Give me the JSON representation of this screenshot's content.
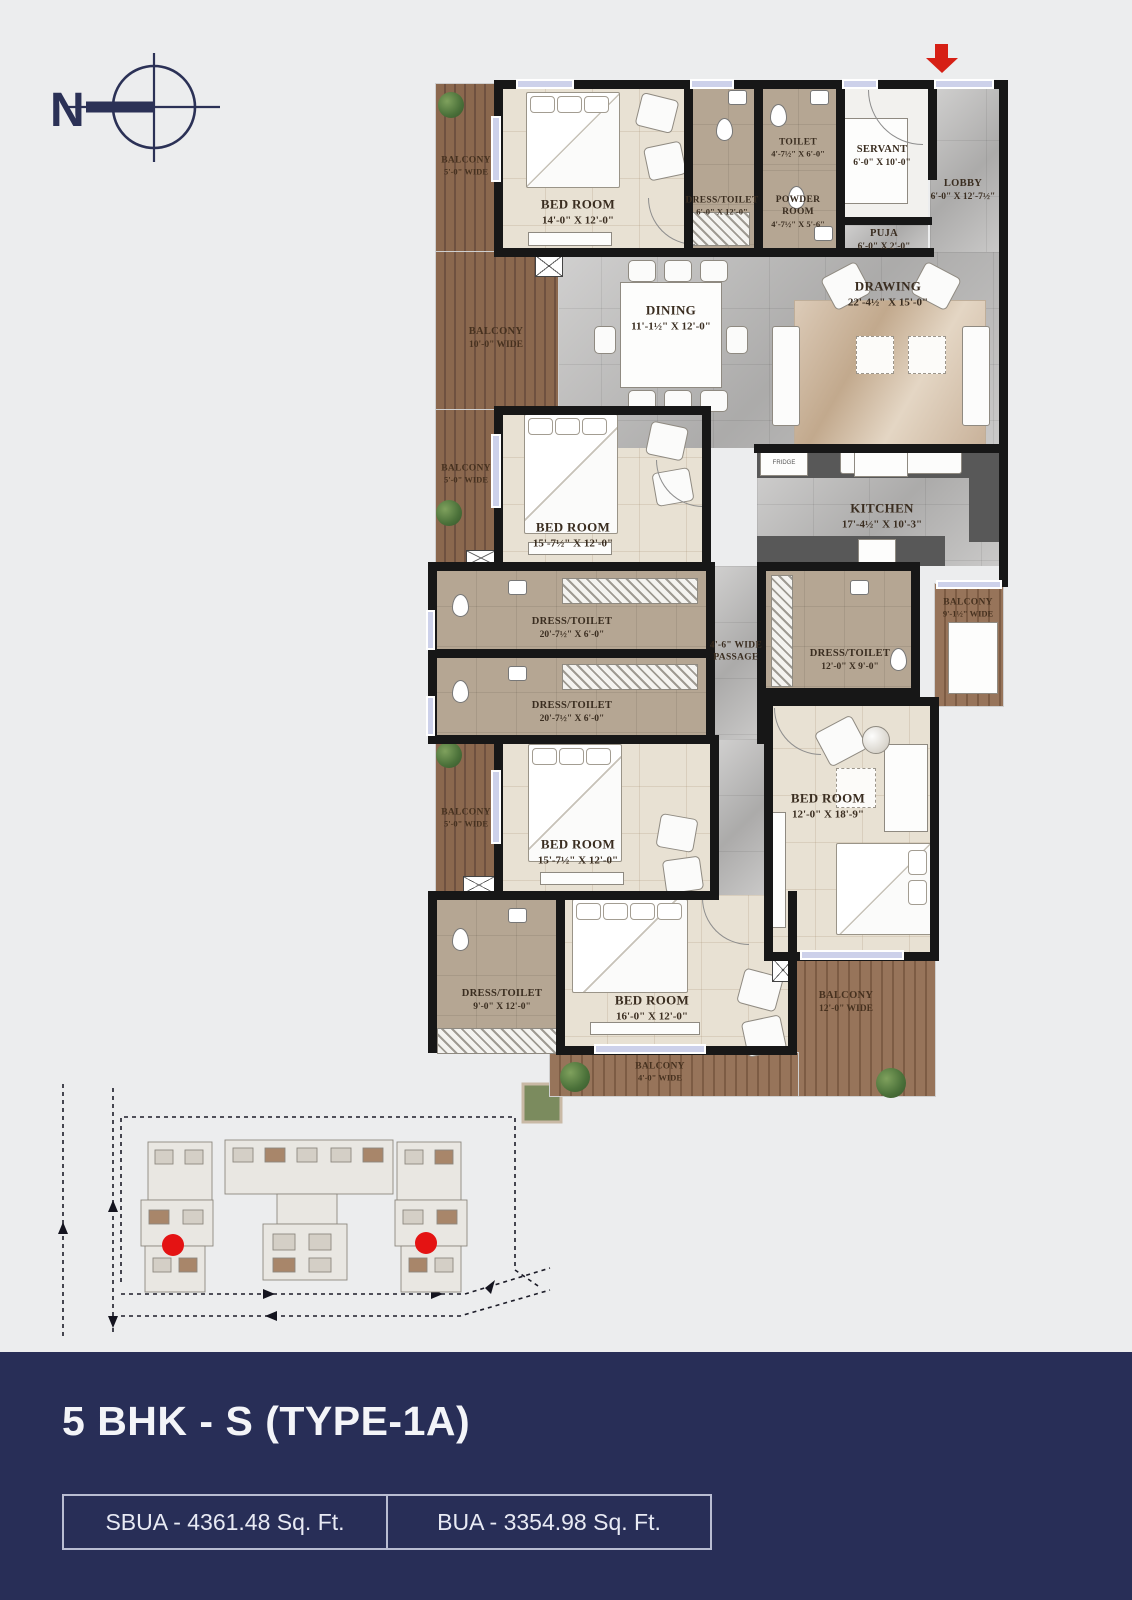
{
  "compass": {
    "label": "N"
  },
  "rooms": [
    {
      "id": "balcony-5-top",
      "line1": "BALCONY",
      "line2": "5'-0\" WIDE"
    },
    {
      "id": "bedroom-14x12",
      "line1": "BED ROOM",
      "line2": "14'-0\" X 12'-0\""
    },
    {
      "id": "dress-toilet-6x12",
      "line1": "DRESS/TOILET",
      "line2": "6'-0\" X 12'-0\""
    },
    {
      "id": "toilet",
      "line1": "TOILET",
      "line2": "4'-7½\" X 6'-0\""
    },
    {
      "id": "powder-room",
      "line1": "POWDER",
      "line2": "ROOM",
      "line3": "4'-7½\" X 5'-6\""
    },
    {
      "id": "servant",
      "line1": "SERVANT",
      "line2": "6'-0\" X 10'-0\""
    },
    {
      "id": "lobby",
      "line1": "LOBBY",
      "line2": "6'-0\" X 12'-7½\""
    },
    {
      "id": "puja",
      "line1": "PUJA",
      "line2": "6'-0\" X 2'-0\""
    },
    {
      "id": "balcony-10",
      "line1": "BALCONY",
      "line2": "10'-0\" WIDE"
    },
    {
      "id": "dining",
      "line1": "DINING",
      "line2": "11'-1½\" X 12'-0\""
    },
    {
      "id": "drawing",
      "line1": "DRAWING",
      "line2": "22'-4½\" X 15'-0\""
    },
    {
      "id": "balcony-5-mid",
      "line1": "BALCONY",
      "line2": "5'-0\" WIDE"
    },
    {
      "id": "bedroom-15a",
      "line1": "BED ROOM",
      "line2": "15'-7½\" X 12'-0\""
    },
    {
      "id": "kitchen",
      "line1": "KITCHEN",
      "line2": "17'-4½\" X 10'-3\""
    },
    {
      "id": "dress-toilet-20a",
      "line1": "DRESS/TOILET",
      "line2": "20'-7½\" X 6'-0\""
    },
    {
      "id": "dress-toilet-20b",
      "line1": "DRESS/TOILET",
      "line2": "20'-7½\" X 6'-0\""
    },
    {
      "id": "passage",
      "line1": "4'-6\" WIDE",
      "line2": "PASSAGE"
    },
    {
      "id": "dress-toilet-12x9",
      "line1": "DRESS/TOILET",
      "line2": "12'-0\" X 9'-0\""
    },
    {
      "id": "balcony-9",
      "line1": "BALCONY",
      "line2": "9'-1½\" WIDE"
    },
    {
      "id": "bedroom-12x18",
      "line1": "BED ROOM",
      "line2": "12'-0\" X 18'-9\""
    },
    {
      "id": "balcony-5-low",
      "line1": "BALCONY",
      "line2": "5'-0\" WIDE"
    },
    {
      "id": "bedroom-15b",
      "line1": "BED ROOM",
      "line2": "15'-7½\" X 12'-0\""
    },
    {
      "id": "dress-toilet-9x12",
      "line1": "DRESS/TOILET",
      "line2": "9'-0\" X 12'-0\""
    },
    {
      "id": "bedroom-16x12",
      "line1": "BED ROOM",
      "line2": "16'-0\" X 12'-0\""
    },
    {
      "id": "balcony-12",
      "line1": "BALCONY",
      "line2": "12'-0\" WIDE"
    },
    {
      "id": "balcony-4",
      "line1": "BALCONY",
      "line2": "4'-0\" WIDE"
    }
  ],
  "kitchen": {
    "fridge_label": "FRIDGE"
  },
  "footer": {
    "title": "5 BHK - S (TYPE-1A)",
    "sbua": "SBUA - 4361.48 Sq. Ft.",
    "bua": "BUA - 3354.98 Sq. Ft."
  },
  "colors": {
    "footer_navy": "#282e57",
    "entry_arrow_red": "#d62015",
    "unit_marker_red": "#e41313",
    "wall_black": "#171717",
    "wood_deck": "#8b684e",
    "marble_grey": "#bfbebd",
    "bedroom_beige": "#e8e1d3",
    "toilet_tan": "#b5a693",
    "label_brown": "#3a2d20"
  }
}
